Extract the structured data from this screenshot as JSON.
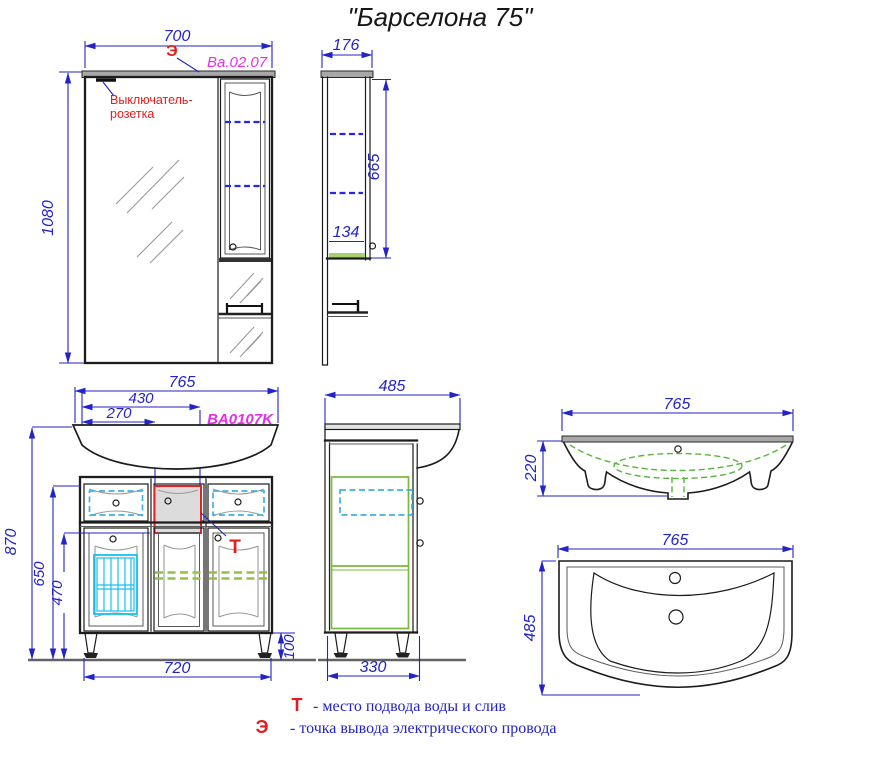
{
  "title": "\"Барселона 75\"",
  "colors": {
    "dimension_blue": "#2323c8",
    "article_magenta": "#e62ee6",
    "marker_red": "#e31c1c",
    "shelf_dashed_blue": "#2626e8",
    "drawer_dashed_cyan": "#3fb0e4",
    "basket_cyan": "#18c0f0",
    "shelf_green": "#8fc43e",
    "sink_green": "#58b43c"
  },
  "mirror_front": {
    "width": "700",
    "height": "1080",
    "marker": "Э",
    "article": "Ba.02.07",
    "note_line1": "Выключатель-",
    "note_line2": "розетка"
  },
  "mirror_side": {
    "depth": "176",
    "door_height": "665",
    "shelf_note": "134"
  },
  "vanity_front": {
    "article": "BA0107K",
    "width": "765",
    "dim_430": "430",
    "dim_270": "270",
    "height": "870",
    "dim_650": "650",
    "dim_470": "470",
    "base_width": "720",
    "leg_height": "100",
    "marker": "Т"
  },
  "vanity_side": {
    "depth": "485",
    "base_depth": "330"
  },
  "sink_front": {
    "width": "765",
    "height": "220"
  },
  "sink_top": {
    "width": "765",
    "depth": "485"
  },
  "legend": [
    {
      "symbol": "Т",
      "text": "-  место подвода воды и слив"
    },
    {
      "symbol": "Э",
      "text": "-  точка вывода электрического провода"
    }
  ]
}
